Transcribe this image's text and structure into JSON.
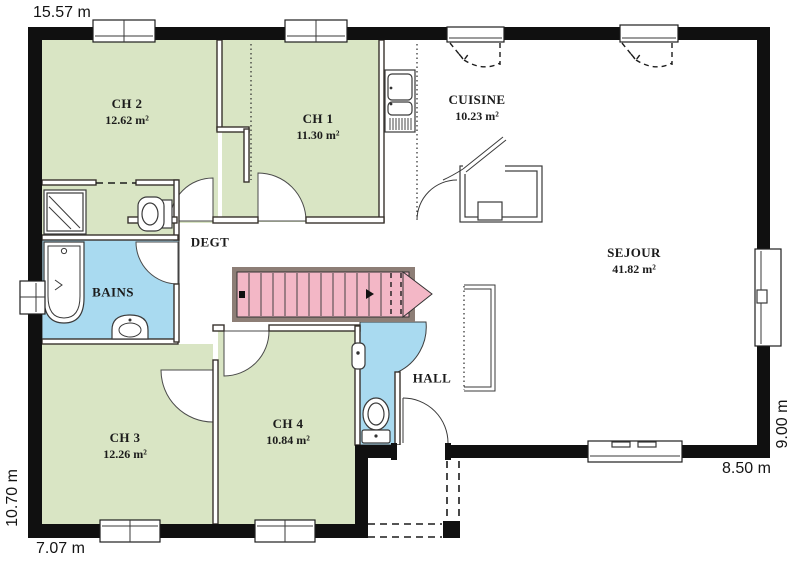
{
  "dimensions": {
    "top": "15.57 m",
    "left": "10.70 m",
    "bottom_left": "7.07 m",
    "bottom_right": "8.50 m",
    "right": "9.00 m"
  },
  "rooms": {
    "ch2": {
      "name": "CH 2",
      "area": "12.62 m²"
    },
    "ch1": {
      "name": "CH 1",
      "area": "11.30 m²"
    },
    "cuisine": {
      "name": "CUISINE",
      "area": "10.23 m²"
    },
    "sejour": {
      "name": "SEJOUR",
      "area": "41.82 m²"
    },
    "degt": {
      "name": "DEGT"
    },
    "bains": {
      "name": "BAINS"
    },
    "hall": {
      "name": "HALL"
    },
    "ch3": {
      "name": "CH 3",
      "area": "12.26 m²"
    },
    "ch4": {
      "name": "CH 4",
      "area": "10.84 m²"
    }
  },
  "fixtures": [
    "staircase",
    "kitchen-sink",
    "dishwasher",
    "pantry-closet",
    "bathtub",
    "shower",
    "toilet",
    "washbasin",
    "entrance-door",
    "windows",
    "porch",
    "counter"
  ],
  "colors": {
    "wall": "#101010",
    "green": "#d9e5c4",
    "blue": "#a9daf0",
    "pink": "#f3b7c6",
    "frame": "#8d7e76"
  }
}
